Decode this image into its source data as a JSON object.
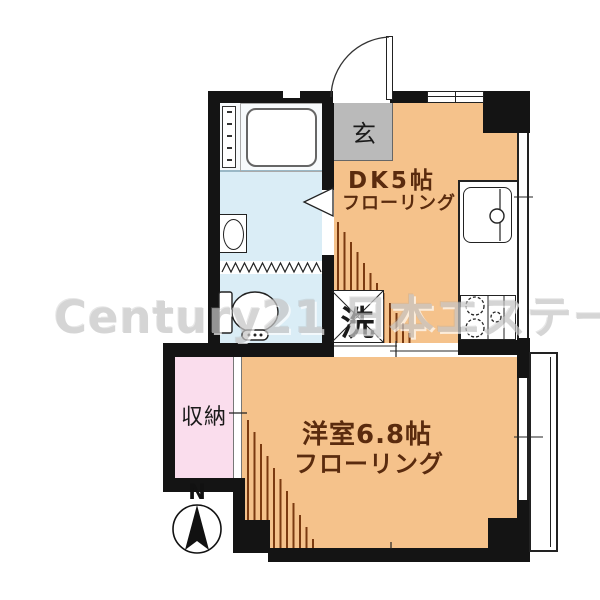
{
  "watermark": "Century21 日本エステート",
  "rooms": {
    "genkan": {
      "label": "玄"
    },
    "dk": {
      "label": "DK5帖",
      "sublabel": "フローリング"
    },
    "western": {
      "label": "洋室6.8帖",
      "sublabel": "フローリング"
    },
    "closet": {
      "label": "収納"
    },
    "laundry": {
      "label": "洗"
    }
  },
  "compass": {
    "label": "N"
  },
  "colors": {
    "room_orange": "#f5c28b",
    "genkan_gray": "#bababa",
    "water_blue": "#daedf6",
    "bath_white": "#f7fafc",
    "closet_pink": "#fadded",
    "stripe_brown": "#7b3a10",
    "label_brown": "#5a2b0e",
    "wall_black": "#141414",
    "watermark_gray": "#c6c6c6"
  }
}
